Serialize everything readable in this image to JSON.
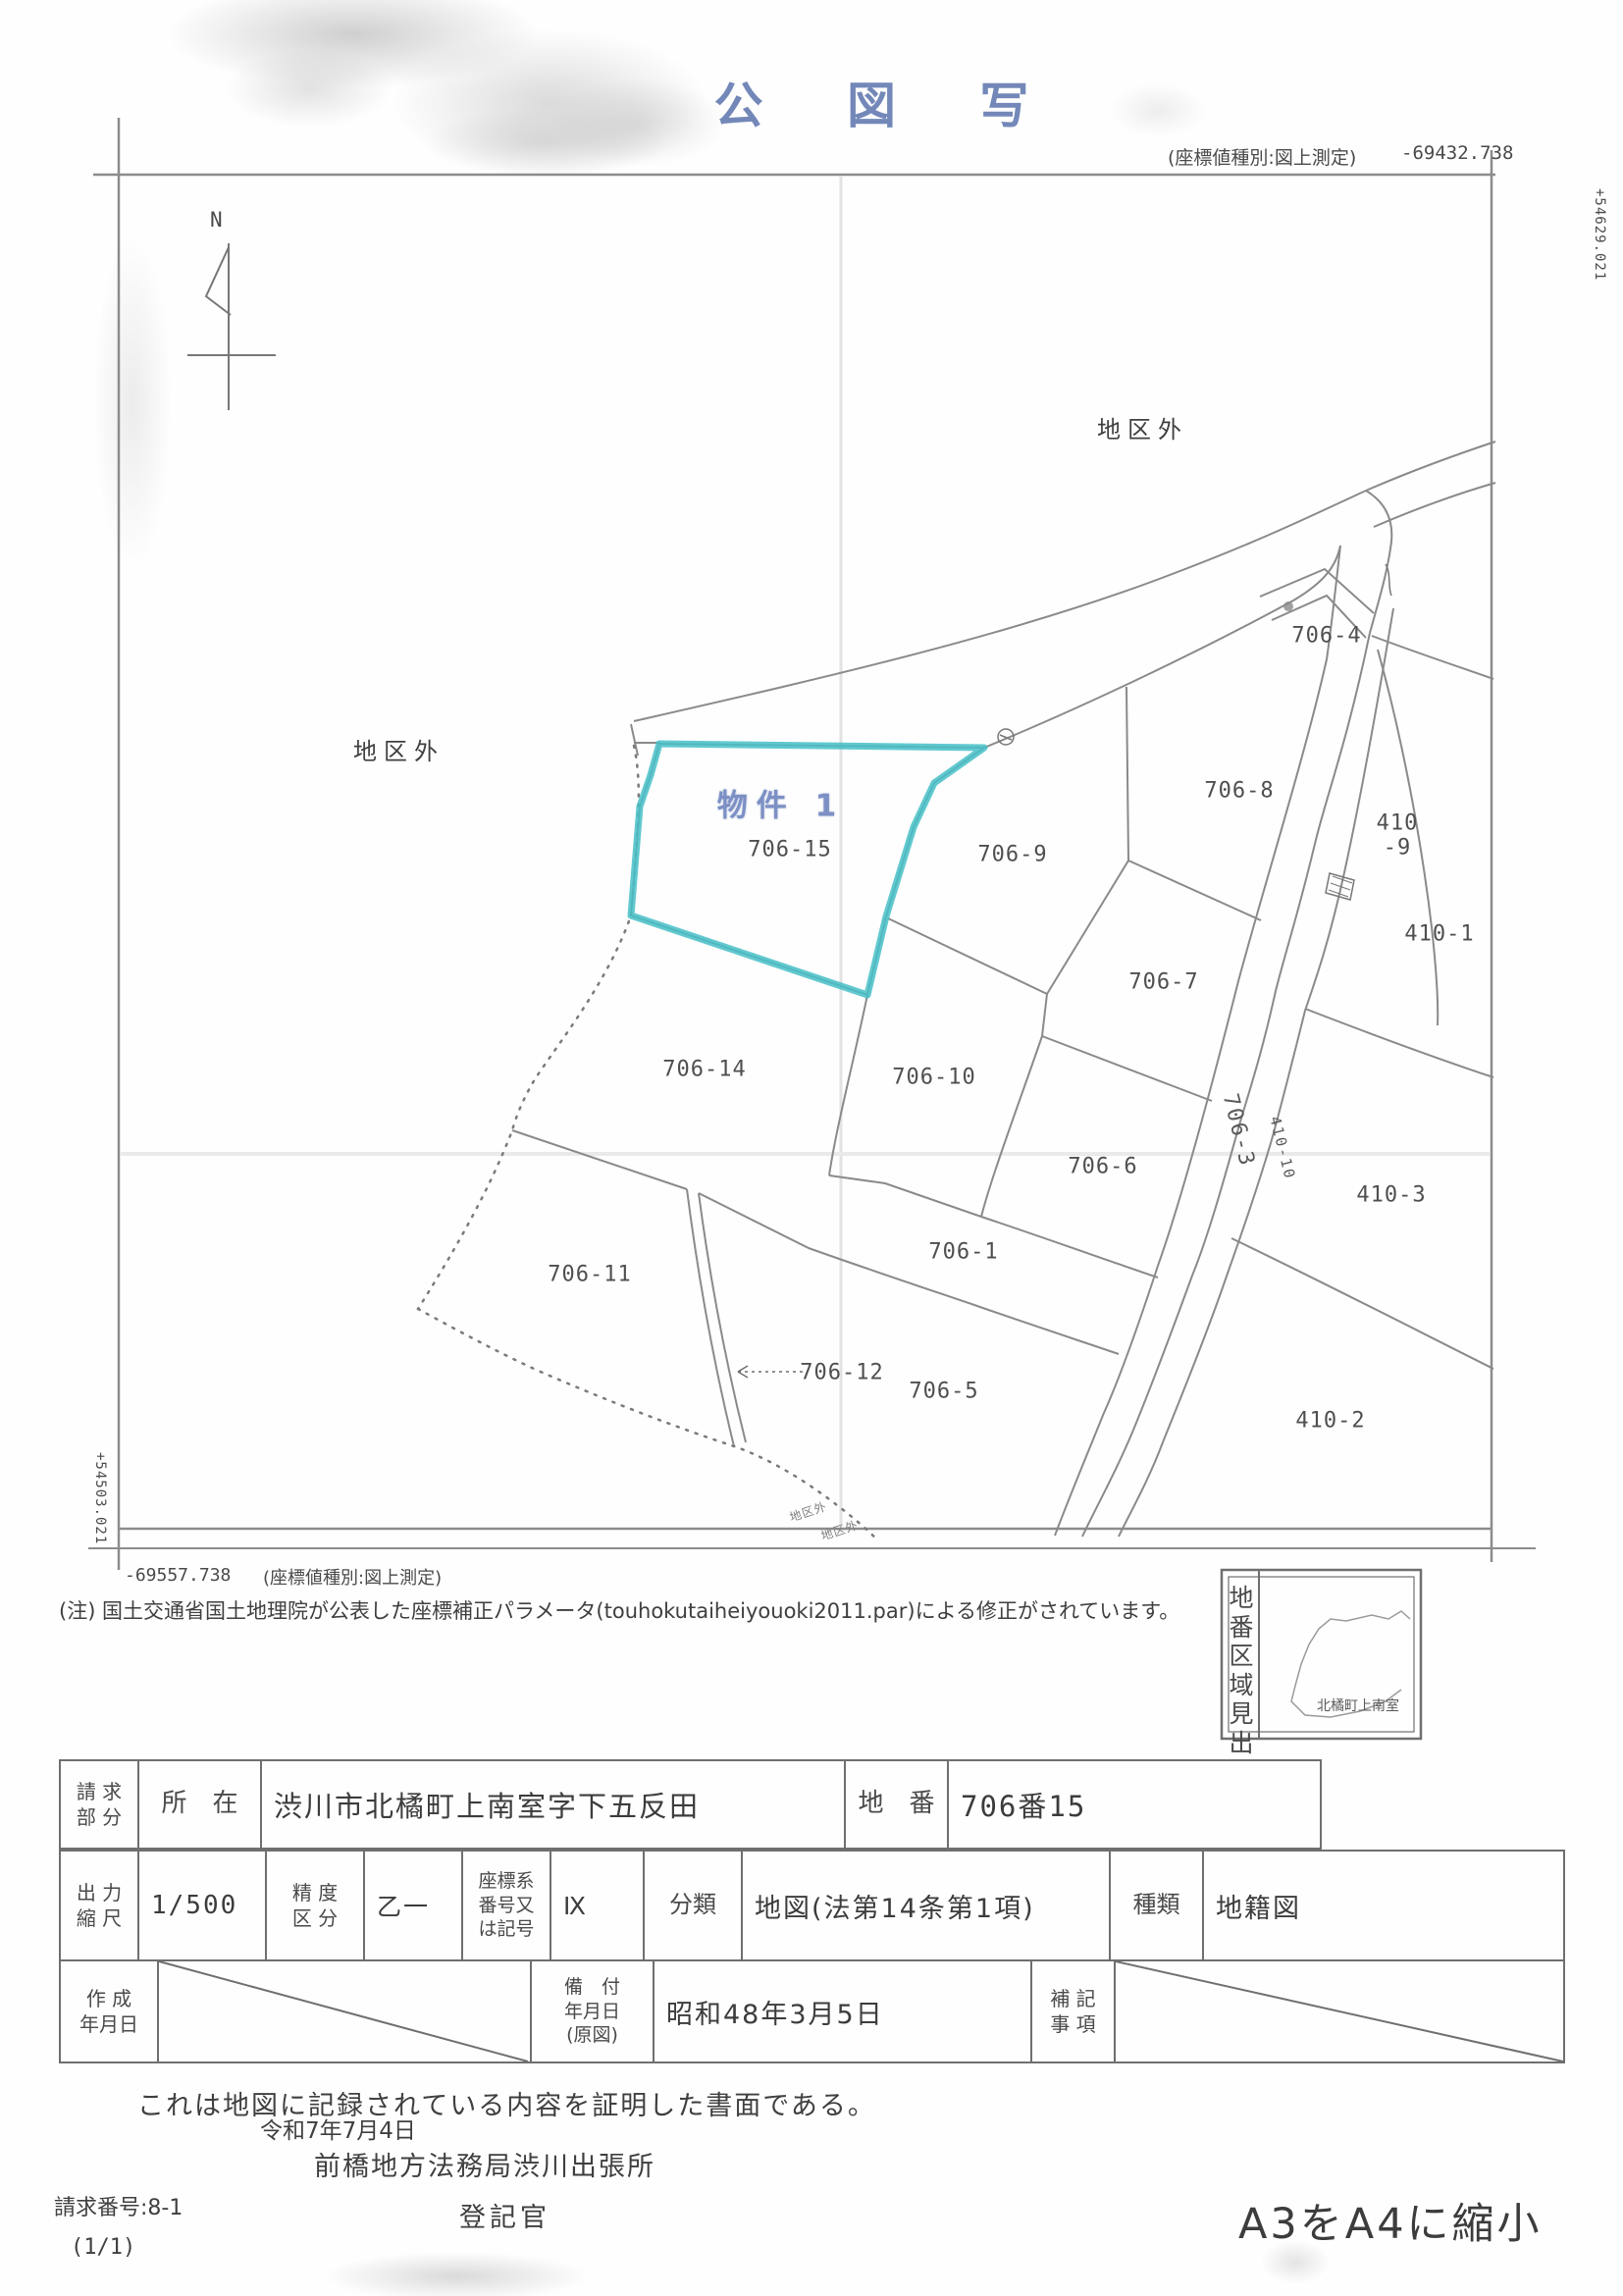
{
  "doc": {
    "title": "公 図 写",
    "certification": "これは地図に記録されている内容を証明した書面である。",
    "note": "(注) 国土交通省国土地理院が公表した座標補正パラメータ(touhokutaiheiyouoki2011.par)による修正がされています。",
    "reduction": "A3をA4に縮小"
  },
  "coords": {
    "top_note": "(座標値種別:図上測定)",
    "top_value": "-69432.738",
    "right_value": "+54629.021",
    "left_value": "+54503.021",
    "bottom_value": "-69557.738",
    "bottom_note": "(座標値種別:図上測定)"
  },
  "map": {
    "north": "N",
    "outside_label": "地区外",
    "stamp": "物件 1",
    "highlight_color": "#45bfc7",
    "stamp_color": "#7c90c4",
    "line_color": "#8a8a8a",
    "parcels": {
      "p706_15": "706-15",
      "p706_4": "706-4",
      "p706_8": "706-8",
      "p410_9": "410\n-9",
      "p410_1": "410-1",
      "p706_9": "706-9",
      "p706_7": "706-7",
      "p706_10": "706-10",
      "p706_6": "706-6",
      "p706_1": "706-1",
      "p706_14": "706-14",
      "p706_11": "706-11",
      "p706_12": "706-12",
      "p706_5": "706-5",
      "p410_3": "410-3",
      "p410_2": "410-2"
    },
    "roads": {
      "r706_3": "706-3",
      "r410_10": "410-10"
    }
  },
  "locator": {
    "title": "地番\n区域\n見出",
    "place": "北橘町上南室"
  },
  "table": {
    "request_label": "請 求\n部 分",
    "location_label": "所　在",
    "location_value": "渋川市北橘町上南室字下五反田",
    "parcel_label": "地　番",
    "parcel_value": "706番15",
    "scale_label": "出 力\n縮 尺",
    "scale_value": "1/500",
    "precision_label": "精 度\n区 分",
    "precision_value": "乙一",
    "coordsys_label": "座標系\n番号又\nは記号",
    "coordsys_value": "Ⅸ",
    "class_label": "分類",
    "class_value": "地図(法第14条第1項)",
    "kind_label": "種類",
    "kind_value": "地籍図",
    "created_label": "作 成\n年月日",
    "filed_label": "備　付\n年月日\n(原図)",
    "filed_value": "昭和48年3月5日",
    "remarks_label": "補 記\n事 項"
  },
  "issue": {
    "date": "令和7年7月4日",
    "office": "前橋地方法務局渋川出張所",
    "officer": "登記官"
  },
  "request": {
    "number": "請求番号:8-1",
    "page": "(1/1)"
  }
}
